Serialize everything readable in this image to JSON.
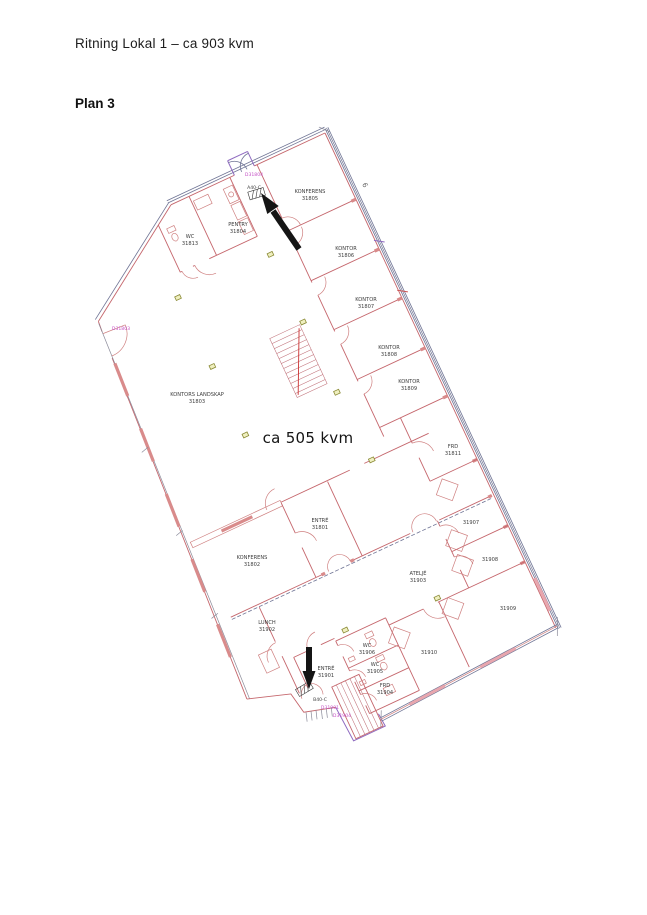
{
  "header": {
    "title": "Ritning Lokal 1 – ca 903 kvm",
    "plan_label": "Plan 3"
  },
  "floorplan": {
    "area_label": {
      "text": "ca 505 kvm",
      "x": 308,
      "y": 443
    },
    "grid_label": {
      "text": "6",
      "x": 363,
      "y": 186,
      "rotate": 65
    },
    "rooms": [
      {
        "name": "KONFERENS",
        "id": "31805",
        "x": 310,
        "y": 193
      },
      {
        "name": "KONTOR",
        "id": "31806",
        "x": 346,
        "y": 250
      },
      {
        "name": "KONTOR",
        "id": "31807",
        "x": 366,
        "y": 301
      },
      {
        "name": "KONTOR",
        "id": "31808",
        "x": 389,
        "y": 349
      },
      {
        "name": "KONTOR",
        "id": "31809",
        "x": 409,
        "y": 383
      },
      {
        "name": "FRD",
        "id": "31811",
        "x": 453,
        "y": 448
      },
      {
        "name": "",
        "id": "31907",
        "x": 471,
        "y": 521
      },
      {
        "name": "",
        "id": "31908",
        "x": 490,
        "y": 558
      },
      {
        "name": "",
        "id": "31909",
        "x": 508,
        "y": 607
      },
      {
        "name": "",
        "id": "31910",
        "x": 429,
        "y": 651
      },
      {
        "name": "ATELJÉ",
        "id": "31903",
        "x": 418,
        "y": 575
      },
      {
        "name": "ENTRÉ",
        "id": "31801",
        "x": 320,
        "y": 522
      },
      {
        "name": "KONFERENS",
        "id": "31802",
        "x": 252,
        "y": 559
      },
      {
        "name": "LUNCH",
        "id": "31902",
        "x": 267,
        "y": 624
      },
      {
        "name": "ENTRÉ",
        "id": "31901",
        "x": 326,
        "y": 670
      },
      {
        "name": "WC",
        "id": "31906",
        "x": 367,
        "y": 647
      },
      {
        "name": "WC",
        "id": "31905",
        "x": 375,
        "y": 666
      },
      {
        "name": "FRD",
        "id": "31904",
        "x": 385,
        "y": 687
      },
      {
        "name": "PENTRY",
        "id": "31804",
        "x": 238,
        "y": 226
      },
      {
        "name": "WC",
        "id": "31813",
        "x": 190,
        "y": 238
      },
      {
        "name": "KONTORS LANDSKAP",
        "id": "31803",
        "x": 197,
        "y": 396
      }
    ],
    "door_labels": [
      {
        "text": "A40-C",
        "x": 254,
        "y": 189,
        "color": "#444444"
      },
      {
        "text": "B40-C",
        "x": 320,
        "y": 701,
        "color": "#444444"
      },
      {
        "text": "D31804",
        "x": 254,
        "y": 176,
        "color": "#c653c6"
      },
      {
        "text": "D31803",
        "x": 121,
        "y": 330,
        "color": "#c653c6"
      },
      {
        "text": "D31901",
        "x": 330,
        "y": 709,
        "color": "#c653c6"
      },
      {
        "text": "D31904",
        "x": 342,
        "y": 717,
        "color": "#c653c6"
      }
    ],
    "colors": {
      "wall_red": "#c5666c",
      "wall_window_fill": "#d98b8b",
      "wall_blue": "#6e7394",
      "wall_dark_blue": "#41466e",
      "frame_purple": "#8f6bc0",
      "annotation_magenta": "#c653c6",
      "symbol_olive": "#8a8a35",
      "stair_pink": "#f0c7d4",
      "arrow_black": "#151515"
    }
  }
}
